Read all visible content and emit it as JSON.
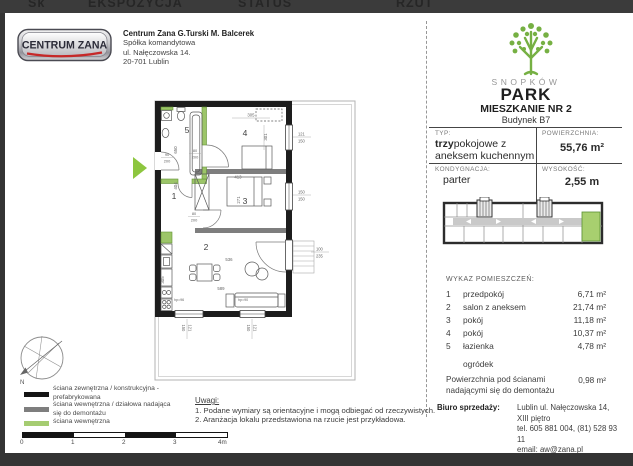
{
  "window_bar": {
    "fragment1": "Sk",
    "fragment2": "EKSPOZYCJA",
    "fragment3": "STATUS",
    "fragment4": "RZUT"
  },
  "header": {
    "logo_text": "CENTRUM ZANA",
    "company_name": "Centrum Zana G.Turski M. Balcerek",
    "company_type": "Spółka komandytowa",
    "company_street": "ul. Nałęczowska 14.",
    "company_city": "20-701 Lublin"
  },
  "branding": {
    "estate_top": "SNOPKÓW",
    "estate_main": "PARK",
    "unit": "MIESZKANIE NR 2",
    "building": "Budynek B7"
  },
  "specs": {
    "typ_label": "TYP:",
    "typ_bold": "trzy",
    "typ_rest": "pokojowe z",
    "typ_line2": "aneksem kuchennym",
    "area_label": "POWIERZCHNIA:",
    "area_value": "55,76 m²",
    "floor_label": "KONDYGNACJA:",
    "floor_value": "parter",
    "height_label": "WYSOKOŚĆ:",
    "height_value": "2,55 m"
  },
  "room_list": {
    "heading": "WYKAZ POMIESZCZEŃ:",
    "items": [
      {
        "no": "1",
        "name": "przedpokój",
        "area": "6,71 m²"
      },
      {
        "no": "2",
        "name": "salon z aneksem",
        "area": "21,74 m²"
      },
      {
        "no": "3",
        "name": "pokój",
        "area": "11,18 m²"
      },
      {
        "no": "4",
        "name": "pokój",
        "area": "10,37 m²"
      },
      {
        "no": "5",
        "name": "łazienka",
        "area": "4,78 m²"
      },
      {
        "no": "",
        "name": "ogródek",
        "area": ""
      }
    ],
    "demontaz_text": "Powierzchnia pod ścianami nadającymi się do demontażu",
    "demontaz_area": "0,98 m²"
  },
  "sales": {
    "label": "Biuro sprzedaży:",
    "line1": "Lublin ul. Nałęczowska 14, XIII piętro",
    "line2": "tel. 605 881 004, (81) 528 93 11",
    "line3": "email: aw@zana.pl"
  },
  "legend": {
    "wall1": "ściana zewnętrzna / konstrukcyjna - prefabrykowana",
    "wall2": "ściana wewnętrzna / działowa nadająca się do demontażu",
    "wall3": "ściana wewnętrzna",
    "scale": [
      "0",
      "1",
      "2",
      "3",
      "4m"
    ]
  },
  "notes": {
    "heading": "Uwagi:",
    "item1": "1. Podane wymiary są orientacyjne i mogą odbiegać od rzeczywistych.",
    "item2": "2. Aranżacja lokalu przedstawiona na rzucie jest przykładowa."
  },
  "plan": {
    "rooms": {
      "r1": "1",
      "r2": "2",
      "r3": "3",
      "r4": "4",
      "r5": "5"
    },
    "dims": {
      "d305": "305",
      "d301": "301",
      "d413": "413",
      "d271": "271",
      "d536": "536",
      "d589": "589",
      "d650": "650",
      "d404": "404",
      "d305b": "305"
    },
    "doors": {
      "ent_w": "90",
      "ent_h": "200",
      "int_w": "80",
      "int_h": "200"
    },
    "windows": {
      "w1_w": "121",
      "w1_h": "150",
      "w2_w": "150",
      "w2_h": "150",
      "bal_w": "100",
      "bal_h": "235",
      "bot_w": "121",
      "bot_h": "150"
    },
    "hp1": "hp=96",
    "hp2": "hp=90",
    "north": "N"
  },
  "colors": {
    "accent_green": "#76b043",
    "wall_green": "#9cc568",
    "wall_gray": "#7e7e7e",
    "wall_black": "#1d1d1d",
    "logo_red": "#c62828"
  }
}
